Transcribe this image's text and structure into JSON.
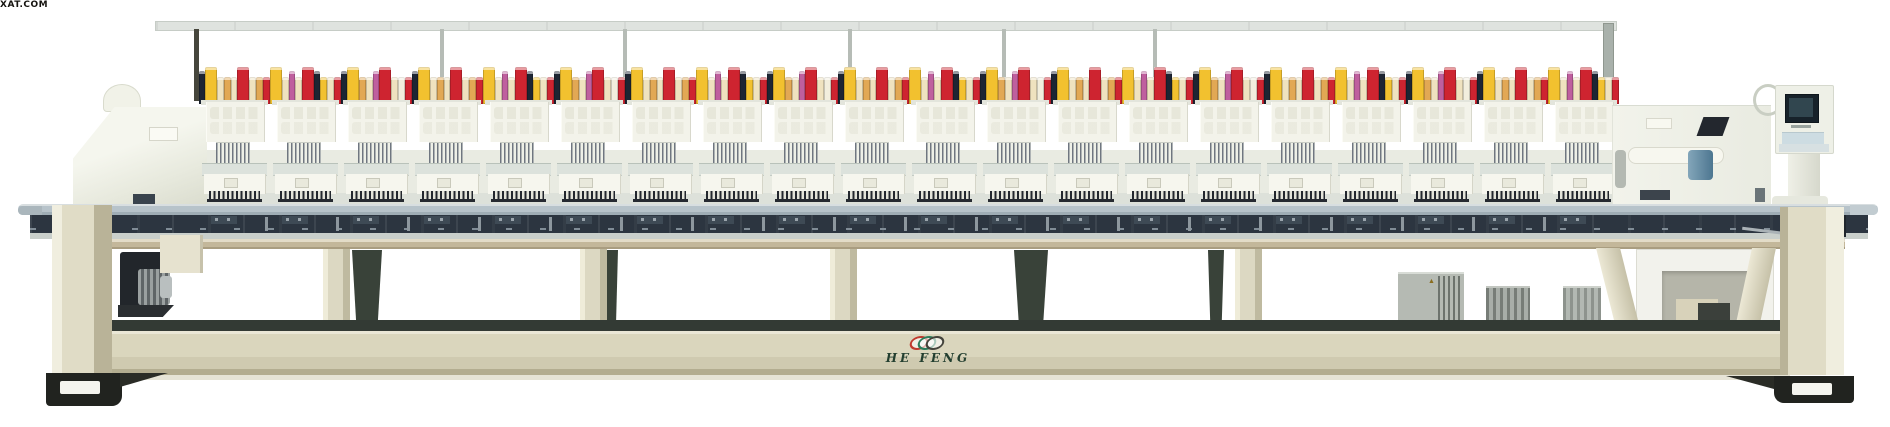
{
  "watermark": "XAT.COM",
  "brand": {
    "name": "HE FENG",
    "text_color": "#233f30",
    "logo_mark_colors": [
      "#c03a2e",
      "#2e7d5b",
      "#44443c"
    ]
  },
  "icons": {
    "warning": "▲"
  },
  "machine": {
    "description_visible": false,
    "head_count": 20,
    "spools_per_head": 9,
    "spool_palette": {
      "yellow": "#F2C12F",
      "cream": "#EFE2BF",
      "tan": "#E2A854",
      "red": "#CE2430",
      "navy": "#1D2533",
      "magenta": "#BF5F9E",
      "white": "#F2EEDD"
    },
    "spool_patterns": [
      [
        {
          "color": "#1D2533",
          "size": "thin"
        },
        {
          "color": "#F2C12F",
          "size": "big"
        },
        {
          "color": "#EFE2BF",
          "size": "small"
        },
        {
          "color": "#E2A854",
          "size": "small"
        },
        {
          "color": "#EFE2BF",
          "size": "small"
        },
        {
          "color": "#CE2430",
          "size": "big"
        },
        {
          "color": "#EFE2BF",
          "size": "small"
        },
        {
          "color": "#E2A854",
          "size": "small"
        },
        {
          "color": "#CE2430",
          "size": "small"
        }
      ],
      [
        {
          "color": "#F2C12F",
          "size": "big"
        },
        {
          "color": "#EFE2BF",
          "size": "small"
        },
        {
          "color": "#BF5F9E",
          "size": "thin"
        },
        {
          "color": "#EFE2BF",
          "size": "small"
        },
        {
          "color": "#CE2430",
          "size": "big"
        },
        {
          "color": "#1D2533",
          "size": "thin"
        },
        {
          "color": "#F2C12F",
          "size": "small"
        },
        {
          "color": "#EFE2BF",
          "size": "small"
        },
        {
          "color": "#CE2430",
          "size": "small"
        }
      ],
      [
        {
          "color": "#1D2533",
          "size": "thin"
        },
        {
          "color": "#F2C12F",
          "size": "big"
        },
        {
          "color": "#E2A854",
          "size": "small"
        },
        {
          "color": "#EFE2BF",
          "size": "small"
        },
        {
          "color": "#BF5F9E",
          "size": "thin"
        },
        {
          "color": "#CE2430",
          "size": "big"
        },
        {
          "color": "#EFE2BF",
          "size": "small"
        },
        {
          "color": "#F2EEDD",
          "size": "small"
        },
        {
          "color": "#CE2430",
          "size": "small"
        }
      ]
    ],
    "palette": {
      "head_body": "#f3f3ea",
      "table": "#b7c3ca",
      "carriage_band": "#2c3540",
      "base_beam": "#dad6bd",
      "legs": "#ddd9c3",
      "feet": "#21231f",
      "control_screen": "#17222a",
      "background": "#ffffff"
    }
  }
}
